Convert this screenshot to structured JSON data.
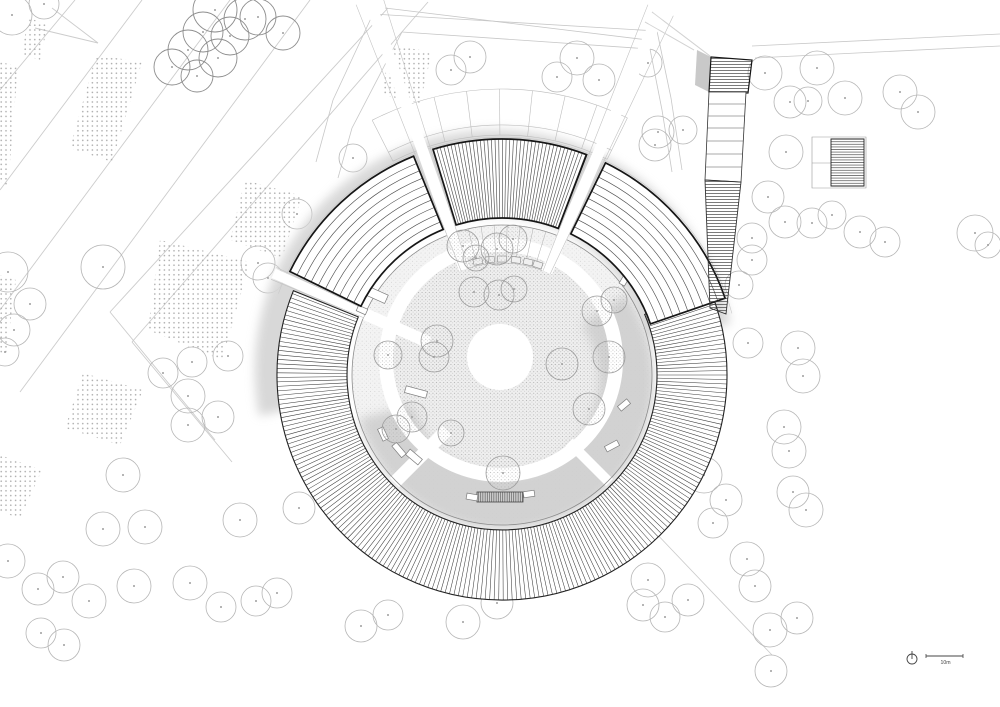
{
  "meta": {
    "title": "Circular pavilion site plan",
    "drawing_type": "architectural-site-plan"
  },
  "canvas": {
    "w": 1000,
    "h": 707,
    "bg": "#ffffff"
  },
  "colors": {
    "hatch": "#3c3c3c",
    "border": "#161616",
    "thin": "#4f4f4f",
    "tree": "#b5b5b5",
    "tree_dark": "#8d8d8d",
    "tree_dot": "#9e9e9e",
    "road": "#cccccc",
    "site_line": "#c7c7c7",
    "shadow": "#d6d6d6",
    "shadow_inner": "#cfcfcf",
    "courtyard_base": "#f3f3f3",
    "plaza_base": "#efefef",
    "outline": "#8c8c8c",
    "faint": "#bdbdbd",
    "white": "#ffffff"
  },
  "building": {
    "center": {
      "x": 502,
      "y": 375
    },
    "ring": {
      "r1": 155,
      "r2": 225,
      "a1": 337,
      "a2": 562,
      "step": 1.15
    },
    "canopies": [
      {
        "kind": "concentric",
        "a1": 206,
        "a2": 248,
        "r1": 157,
        "r2": 236,
        "lines": 11
      },
      {
        "kind": "radial",
        "a1": 253,
        "a2": 291,
        "r1": 157,
        "r2": 236,
        "step": 0.9
      },
      {
        "kind": "concentric",
        "a1": 296,
        "a2": 341,
        "r1": 157,
        "r2": 236,
        "lines": 11
      }
    ],
    "forecourt": {
      "a1": 243,
      "a2": 296,
      "radii": [
        240,
        250,
        286
      ],
      "dividers": 9
    },
    "outer_faint_arc": {
      "r": 238,
      "a1": 200,
      "a2": 345
    },
    "wedges": [
      {
        "a1": 202.5,
        "a2": 205.5,
        "r1": 150,
        "r2": 250
      },
      {
        "a1": 248.5,
        "a2": 252.5,
        "r1": 112,
        "r2": 398
      },
      {
        "a1": 291.5,
        "a2": 295.5,
        "r1": 112,
        "r2": 398
      }
    ],
    "courtyard": {
      "r": 150,
      "plaza": {
        "cx": 501,
        "cy": 360,
        "r_dots": 108,
        "r_ring": 115,
        "ring_w": 14
      },
      "center_circle": {
        "cx": 500,
        "cy": 357,
        "r": 33
      },
      "cross_paths": [
        {
          "a": 135,
          "r1": 78,
          "r2": 152,
          "w": 13
        },
        {
          "a": 45,
          "r1": 95,
          "r2": 152,
          "w": 10
        },
        {
          "a": 204,
          "r1": 80,
          "r2": 155,
          "w": 12
        }
      ],
      "terrace": {
        "arc_r": 112,
        "a1": 253,
        "a2": 291,
        "line_angles": [
          257,
          262,
          267,
          272,
          277,
          282,
          287
        ],
        "planter_angles": [
          258,
          264,
          270,
          277,
          283,
          288
        ],
        "planter_r": 112
      }
    },
    "shadows": {
      "outer": {
        "r1": 152,
        "r2": 240,
        "a1": 168,
        "a2": 350,
        "dx": -8,
        "dy": -9
      },
      "inner": {
        "r1": 95,
        "r2": 150,
        "a1": -35,
        "a2": 165,
        "dx": 2,
        "dy": 5
      }
    },
    "stairs": {
      "x": 500,
      "y": 497,
      "w": 46,
      "h": 10,
      "flanks": [
        [
          472,
          497,
          11,
          6,
          10
        ],
        [
          529,
          494,
          11,
          6,
          -8
        ]
      ]
    },
    "benches": [
      [
        370,
        292,
        36,
        9,
        24
      ],
      [
        362,
        310,
        10,
        6,
        24
      ],
      [
        416,
        392,
        22,
        7,
        15
      ],
      [
        414,
        457,
        16,
        7,
        40
      ],
      [
        383,
        434,
        13,
        6,
        65
      ],
      [
        399,
        450,
        15,
        6,
        50
      ],
      [
        612,
        446,
        14,
        6,
        -28
      ],
      [
        624,
        405,
        12,
        6,
        -40
      ],
      [
        625,
        279,
        13,
        6,
        -60
      ],
      [
        622,
        261,
        12,
        6,
        -58
      ]
    ],
    "plaza_trees": [
      [
        463,
        246,
        16
      ],
      [
        497,
        249,
        16
      ],
      [
        513,
        239,
        14
      ],
      [
        476,
        258,
        13
      ],
      [
        474,
        292,
        15
      ],
      [
        499,
        295,
        15
      ],
      [
        514,
        289,
        13
      ],
      [
        437,
        341,
        16
      ],
      [
        434,
        357,
        15
      ],
      [
        412,
        417,
        15
      ],
      [
        396,
        429,
        14
      ],
      [
        388,
        355,
        14
      ],
      [
        562,
        364,
        16
      ],
      [
        597,
        311,
        15
      ],
      [
        614,
        300,
        13
      ],
      [
        609,
        357,
        16
      ],
      [
        589,
        409,
        16
      ],
      [
        503,
        473,
        17
      ],
      [
        451,
        433,
        13
      ]
    ]
  },
  "tower": {
    "top_block": [
      [
        711,
        57
      ],
      [
        752,
        60
      ],
      [
        748,
        93
      ],
      [
        709,
        92
      ]
    ],
    "shadow_quad": [
      [
        697,
        50
      ],
      [
        711,
        57
      ],
      [
        709,
        92
      ],
      [
        695,
        85
      ]
    ],
    "rooflines": [
      [
        652,
        12,
        710,
        56
      ],
      [
        645,
        22,
        694,
        50
      ]
    ],
    "shaft": {
      "pts": [
        [
          709,
          92
        ],
        [
          746,
          92
        ],
        [
          741,
          182
        ],
        [
          705,
          180
        ]
      ],
      "divider_ys": [
        104,
        116,
        128,
        141,
        154,
        167
      ],
      "top_y": 92,
      "bot_y": 181
    },
    "ramp": [
      [
        705,
        180
      ],
      [
        741,
        182
      ],
      [
        726,
        314
      ],
      [
        710,
        308
      ]
    ],
    "annex": {
      "outer": [
        [
          812,
          137
        ],
        [
          866,
          137
        ],
        [
          866,
          188
        ],
        [
          812,
          188
        ]
      ],
      "hatched": [
        [
          831,
          139
        ],
        [
          864,
          139
        ],
        [
          864,
          186
        ],
        [
          831,
          186
        ]
      ],
      "divider": [
        812,
        163,
        831,
        163
      ]
    }
  },
  "site": {
    "roads": [
      [
        75,
        0,
        0,
        90
      ],
      [
        142,
        0,
        0,
        190
      ],
      [
        230,
        0,
        0,
        310
      ],
      [
        310,
        0,
        20,
        392
      ],
      [
        388,
        8,
        110,
        312
      ],
      [
        428,
        2,
        132,
        342
      ],
      [
        110,
        312,
        215,
        440
      ],
      [
        132,
        342,
        232,
        462
      ],
      [
        35,
        28,
        98,
        43
      ],
      [
        52,
        8,
        98,
        43
      ],
      [
        653,
        530,
        772,
        655
      ]
    ],
    "boundary": [
      [
        385,
        8,
        648,
        40
      ],
      [
        752,
        46,
        1000,
        34
      ],
      [
        755,
        58,
        1000,
        46
      ],
      [
        652,
        12,
        710,
        56
      ],
      [
        645,
        22,
        694,
        50
      ],
      [
        373,
        14,
        657,
        31
      ],
      [
        402,
        32,
        650,
        49
      ],
      [
        657,
        31,
        671,
        98
      ],
      [
        650,
        49,
        662,
        110
      ],
      [
        671,
        98,
        682,
        170
      ],
      [
        662,
        110,
        672,
        172
      ],
      [
        373,
        14,
        333,
        100
      ],
      [
        402,
        32,
        352,
        128
      ],
      [
        333,
        100,
        316,
        162
      ],
      [
        352,
        128,
        338,
        178
      ]
    ],
    "patches": [
      [
        [
          96,
          55
        ],
        [
          142,
          62
        ],
        [
          112,
          162
        ],
        [
          70,
          148
        ]
      ],
      [
        [
          28,
          18
        ],
        [
          48,
          24
        ],
        [
          40,
          60
        ],
        [
          22,
          54
        ]
      ],
      [
        [
          0,
          62
        ],
        [
          18,
          66
        ],
        [
          8,
          186
        ],
        [
          0,
          182
        ]
      ],
      [
        [
          0,
          275
        ],
        [
          16,
          280
        ],
        [
          6,
          355
        ],
        [
          0,
          352
        ]
      ],
      [
        [
          0,
          455
        ],
        [
          42,
          470
        ],
        [
          20,
          518
        ],
        [
          0,
          512
        ]
      ],
      [
        [
          160,
          240
        ],
        [
          250,
          262
        ],
        [
          222,
          360
        ],
        [
          148,
          330
        ]
      ],
      [
        [
          83,
          373
        ],
        [
          143,
          390
        ],
        [
          120,
          445
        ],
        [
          65,
          428
        ]
      ],
      [
        [
          245,
          180
        ],
        [
          302,
          196
        ],
        [
          282,
          258
        ],
        [
          230,
          240
        ]
      ],
      [
        [
          390,
          45
        ],
        [
          432,
          52
        ],
        [
          420,
          103
        ],
        [
          382,
          95
        ]
      ]
    ],
    "trees": [
      [
        12,
        15,
        20
      ],
      [
        44,
        4,
        15
      ],
      [
        470,
        57,
        16
      ],
      [
        451,
        70,
        15
      ],
      [
        577,
        58,
        17
      ],
      [
        557,
        77,
        15
      ],
      [
        599,
        80,
        16
      ],
      [
        648,
        63,
        14
      ],
      [
        658,
        132,
        16
      ],
      [
        655,
        145,
        16
      ],
      [
        683,
        130,
        14
      ],
      [
        765,
        73,
        17
      ],
      [
        817,
        68,
        17
      ],
      [
        845,
        98,
        17
      ],
      [
        900,
        92,
        17
      ],
      [
        918,
        112,
        17
      ],
      [
        790,
        102,
        16
      ],
      [
        808,
        101,
        14
      ],
      [
        786,
        152,
        17
      ],
      [
        768,
        197,
        16
      ],
      [
        785,
        222,
        16
      ],
      [
        812,
        223,
        15
      ],
      [
        832,
        215,
        14
      ],
      [
        860,
        232,
        16
      ],
      [
        885,
        242,
        15
      ],
      [
        752,
        238,
        15
      ],
      [
        752,
        260,
        15
      ],
      [
        739,
        285,
        14
      ],
      [
        975,
        233,
        18
      ],
      [
        988,
        245,
        13
      ],
      [
        103,
        267,
        22
      ],
      [
        8,
        272,
        20
      ],
      [
        30,
        304,
        16
      ],
      [
        14,
        330,
        16
      ],
      [
        5,
        352,
        14
      ],
      [
        258,
        263,
        17
      ],
      [
        268,
        278,
        15
      ],
      [
        228,
        356,
        15
      ],
      [
        192,
        362,
        15
      ],
      [
        163,
        373,
        15
      ],
      [
        188,
        396,
        17
      ],
      [
        188,
        425,
        17
      ],
      [
        218,
        417,
        16
      ],
      [
        123,
        475,
        17
      ],
      [
        240,
        520,
        17
      ],
      [
        299,
        508,
        16
      ],
      [
        748,
        343,
        15
      ],
      [
        798,
        348,
        17
      ],
      [
        803,
        376,
        17
      ],
      [
        784,
        427,
        17
      ],
      [
        789,
        451,
        17
      ],
      [
        793,
        492,
        16
      ],
      [
        806,
        510,
        17
      ],
      [
        704,
        475,
        18
      ],
      [
        726,
        500,
        16
      ],
      [
        713,
        523,
        15
      ],
      [
        8,
        561,
        17
      ],
      [
        103,
        529,
        17
      ],
      [
        145,
        527,
        17
      ],
      [
        38,
        589,
        16
      ],
      [
        63,
        577,
        16
      ],
      [
        89,
        601,
        17
      ],
      [
        134,
        586,
        17
      ],
      [
        190,
        583,
        17
      ],
      [
        221,
        607,
        15
      ],
      [
        256,
        601,
        15
      ],
      [
        277,
        593,
        15
      ],
      [
        41,
        633,
        15
      ],
      [
        64,
        645,
        16
      ],
      [
        361,
        626,
        16
      ],
      [
        388,
        615,
        15
      ],
      [
        463,
        622,
        17
      ],
      [
        497,
        603,
        16
      ],
      [
        648,
        580,
        17
      ],
      [
        643,
        605,
        16
      ],
      [
        665,
        617,
        15
      ],
      [
        688,
        600,
        16
      ],
      [
        770,
        630,
        17
      ],
      [
        797,
        618,
        16
      ],
      [
        771,
        671,
        16
      ],
      [
        747,
        559,
        17
      ],
      [
        755,
        586,
        16
      ],
      [
        353,
        158,
        14
      ],
      [
        297,
        214,
        15
      ]
    ],
    "dark_trees": [
      [
        215,
        10,
        22
      ],
      [
        203,
        32,
        20
      ],
      [
        245,
        19,
        21
      ],
      [
        230,
        36,
        19
      ],
      [
        188,
        50,
        20
      ],
      [
        218,
        58,
        19
      ],
      [
        172,
        67,
        18
      ],
      [
        258,
        17,
        18
      ],
      [
        283,
        33,
        17
      ],
      [
        197,
        76,
        16
      ]
    ]
  },
  "legend": {
    "scale_label": "10m",
    "north": {
      "cx": 912,
      "cy": 659,
      "r": 5
    },
    "bar": {
      "x1": 926,
      "x2": 963,
      "y": 656
    }
  }
}
